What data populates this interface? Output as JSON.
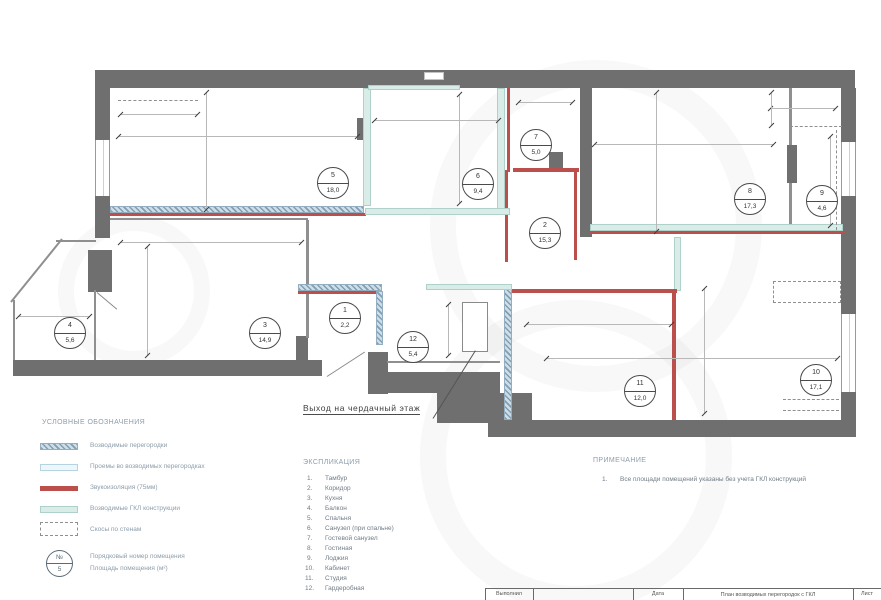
{
  "plan": {
    "exit_label": "Выход на чердачный этаж",
    "rooms": [
      {
        "num": "1",
        "area": "2,2"
      },
      {
        "num": "2",
        "area": "15,3"
      },
      {
        "num": "3",
        "area": "14,9"
      },
      {
        "num": "4",
        "area": "5,6"
      },
      {
        "num": "5",
        "area": "18,0"
      },
      {
        "num": "6",
        "area": "9,4"
      },
      {
        "num": "7",
        "area": "5,0"
      },
      {
        "num": "8",
        "area": "17,3"
      },
      {
        "num": "9",
        "area": "4,6"
      },
      {
        "num": "10",
        "area": "17,1"
      },
      {
        "num": "11",
        "area": "12,0"
      },
      {
        "num": "12",
        "area": "5,4"
      }
    ]
  },
  "legend": {
    "title": "УСЛОВНЫЕ ОБОЗНАЧЕНИЯ",
    "items": [
      {
        "label": "Возводимые перегородки"
      },
      {
        "label": "Проемы во возводимых перегородках"
      },
      {
        "label": "Звукоизоляция (75мм)"
      },
      {
        "label": "Возводимые ГКЛ конструкции"
      },
      {
        "label": "Скосы по стенам"
      }
    ],
    "badge_symbol_top": "№",
    "badge_symbol_bottom": "5",
    "badge_label_line1": "Порядковый номер помещения",
    "badge_label_line2": "Площадь помещения (м²)"
  },
  "explication": {
    "title": "ЭКСПЛИКАЦИЯ",
    "items": [
      {
        "num": "1.",
        "name": "Тамбур"
      },
      {
        "num": "2.",
        "name": "Коридор"
      },
      {
        "num": "3.",
        "name": "Кухня"
      },
      {
        "num": "4.",
        "name": "Балкон"
      },
      {
        "num": "5.",
        "name": "Спальня"
      },
      {
        "num": "6.",
        "name": "Санузел (при спальне)"
      },
      {
        "num": "7.",
        "name": "Гостевой санузел"
      },
      {
        "num": "8.",
        "name": "Гостиная"
      },
      {
        "num": "9.",
        "name": "Лоджия"
      },
      {
        "num": "10.",
        "name": "Кабинет"
      },
      {
        "num": "11.",
        "name": "Студия"
      },
      {
        "num": "12.",
        "name": "Гардеробная"
      }
    ]
  },
  "note": {
    "title": "ПРИМЕЧАНИЕ",
    "item_num": "1.",
    "item_text": "Все площади помещений указаны без учета ГКЛ конструкций"
  },
  "titleblock": {
    "author_label": "Выполнил",
    "date_label": "Дата",
    "drawing_title": "План возводимых перегородок с ГКЛ",
    "sheet_label": "Лист"
  },
  "colors": {
    "wall": "#6f6f6f",
    "soundproofing": "#bb4f4b",
    "partition_hatch": "#7f9fb5",
    "gkl": "#d9ece7",
    "opening": "#eef6fa"
  }
}
